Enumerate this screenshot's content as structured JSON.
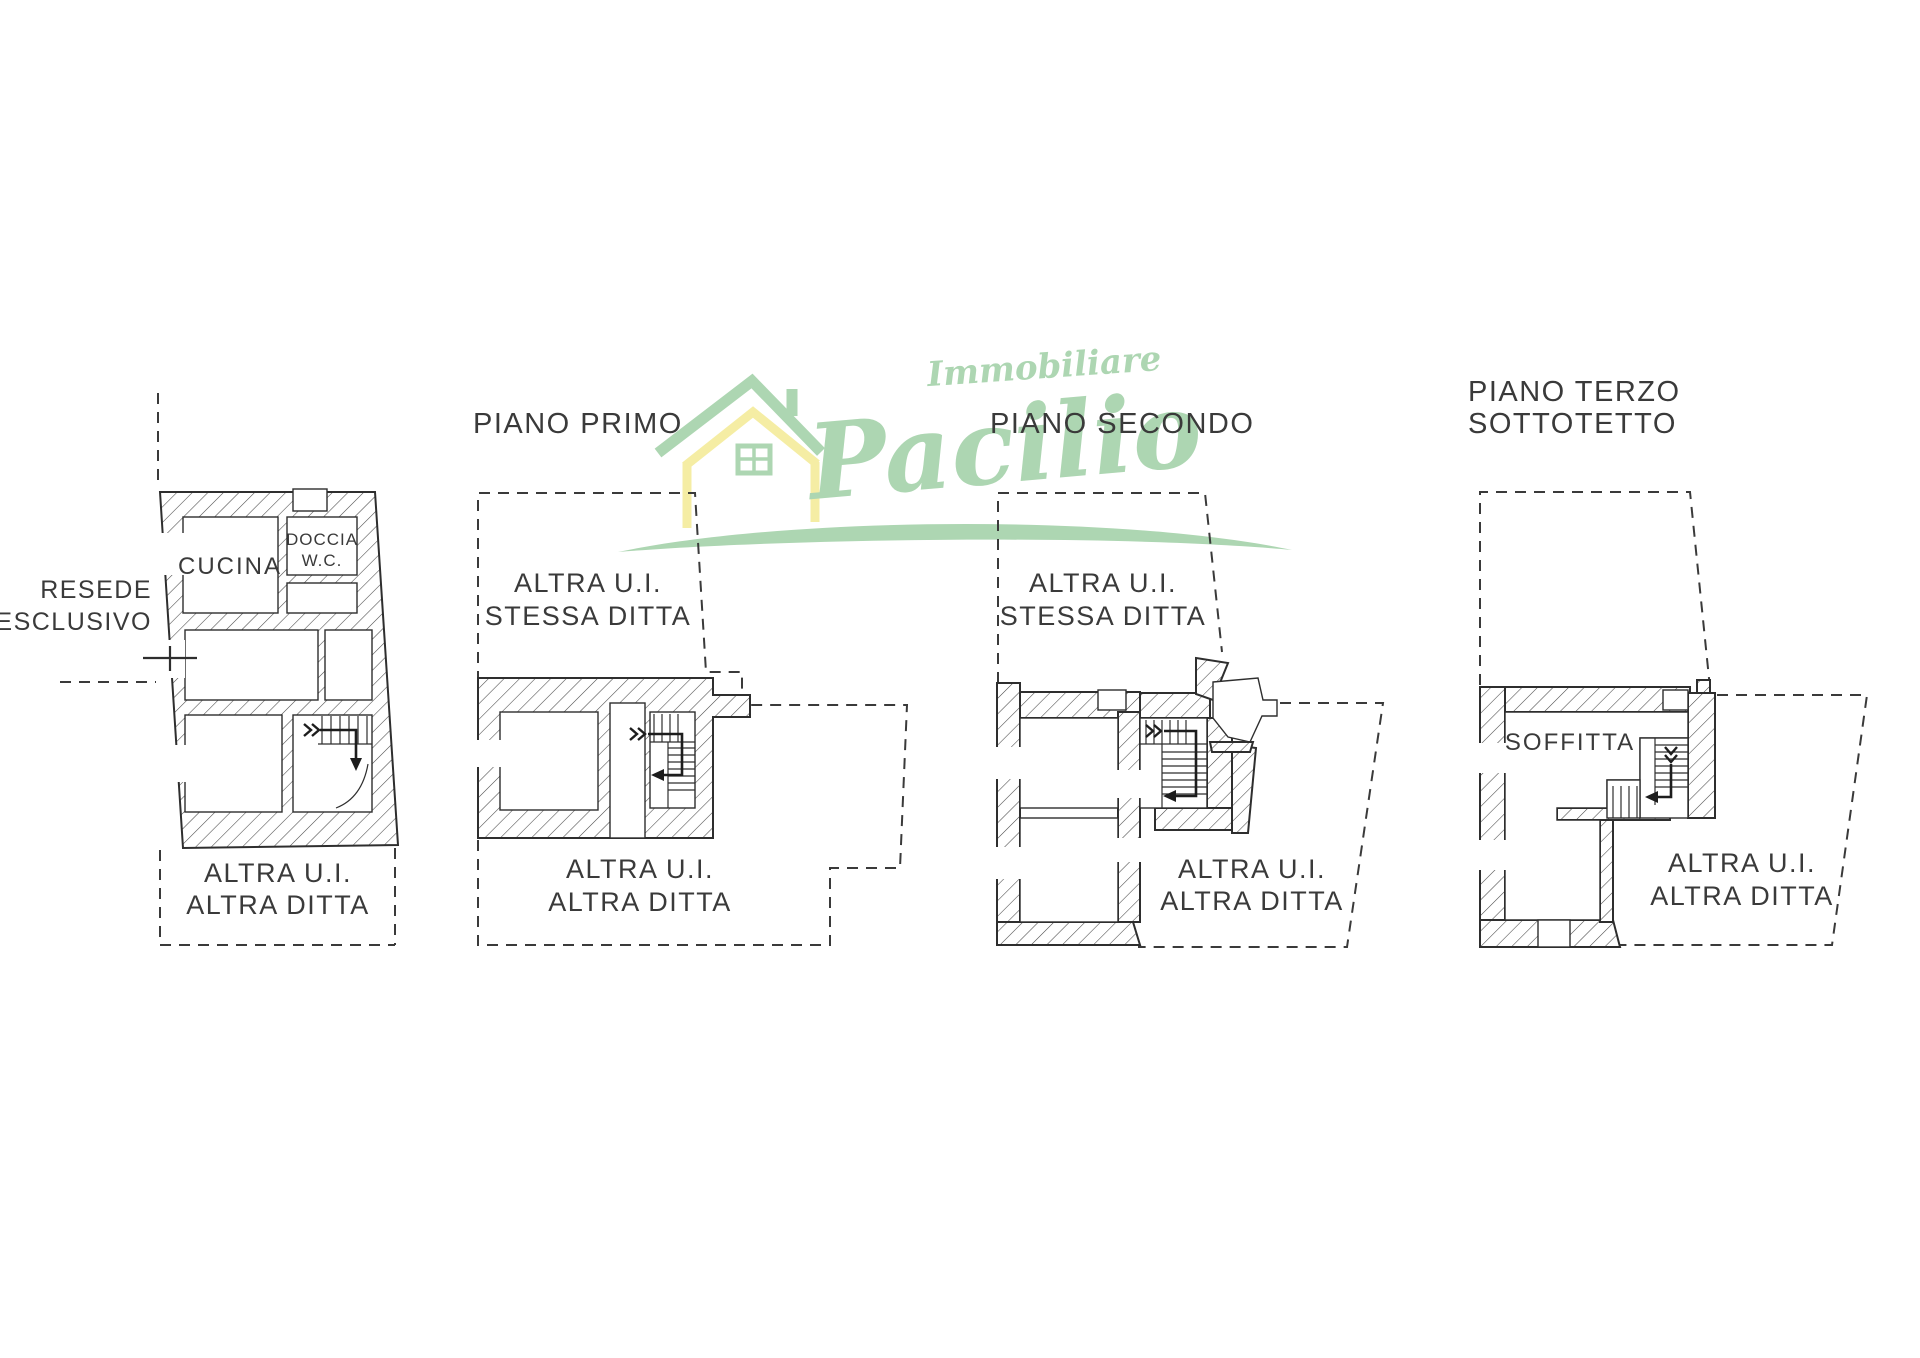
{
  "colors": {
    "ink": "#3a3a3a",
    "line": "#2e2e2e",
    "brand_green": "#a9d4ae",
    "brand_yellow": "#f5eda0"
  },
  "watermark": {
    "brand_top": "Immobiliare",
    "brand_main": "Pacilio"
  },
  "plan_ground": {
    "side_label_line1": "RESEDE",
    "side_label_line2": "ESCLUSIVO",
    "room_kitchen": "CUCINA",
    "room_shower_line1": "DOCCIA",
    "room_shower_line2": "W.C.",
    "zone_other_line1": "ALTRA U.I.",
    "zone_other_line2": "ALTRA DITTA"
  },
  "plan_first": {
    "title": "PIANO PRIMO",
    "zone_same_line1": "ALTRA U.I.",
    "zone_same_line2": "STESSA DITTA",
    "zone_other_line1": "ALTRA U.I.",
    "zone_other_line2": "ALTRA DITTA"
  },
  "plan_second": {
    "title": "PIANO SECONDO",
    "zone_same_line1": "ALTRA U.I.",
    "zone_same_line2": "STESSA DITTA",
    "zone_other_line1": "ALTRA U.I.",
    "zone_other_line2": "ALTRA DITTA"
  },
  "plan_third": {
    "title_line1": "PIANO TERZO",
    "title_line2": "SOTTOTETTO",
    "room_attic": "SOFFITTA",
    "zone_other_line1": "ALTRA U.I.",
    "zone_other_line2": "ALTRA DITTA"
  }
}
